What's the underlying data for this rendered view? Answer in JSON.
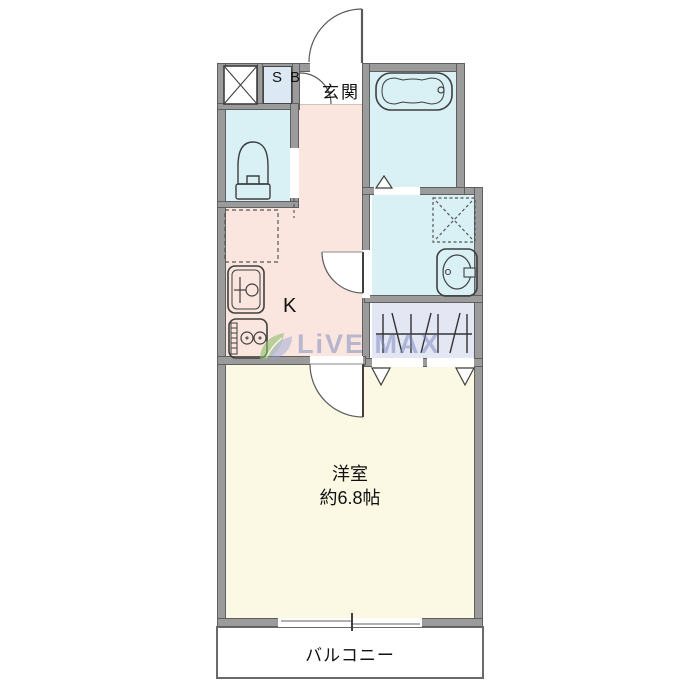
{
  "floorplan": {
    "type": "real-estate-floorplan-1K",
    "rooms": {
      "entrance": {
        "label": "玄関"
      },
      "shoe_box": {
        "label": "SB"
      },
      "kitchen": {
        "label": "K"
      },
      "western_room": {
        "label": "洋室",
        "size": "約6.8帖"
      },
      "balcony": {
        "label": "バルコニー"
      }
    },
    "watermark": {
      "text": "LiVE MAX"
    },
    "colors": {
      "wall_fill": "#9b9b9b",
      "wall_edge": "#5f5f5f",
      "outline": "#3f3f3f",
      "kitchen": "#fae6de",
      "wet_area": "#d9f0f4",
      "closet": "#e3e6f3",
      "western_room": "#fbf8e4",
      "shoe_box_bg": "#dce8f4",
      "entrance_bg": "#ffffff",
      "balcony_bg": "#ffffff",
      "watermark_text": "#8c96c8",
      "watermark_leaf_green": "#8fbf6f",
      "watermark_leaf_blue": "#8fa0d8"
    },
    "fixtures": [
      "pipe-space-x-box",
      "shoe-box",
      "bathtub",
      "toilet",
      "refrigerator-space-dashed",
      "kitchen-sink",
      "gas-stove",
      "washing-machine-space-dashed",
      "washbasin",
      "hanger-pipe",
      "sliding-window",
      "entrance-door-swing",
      "entrance-inner-door-swing",
      "washroom-door-swing",
      "room-door-swing",
      "bathroom-folding-door-triangle",
      "closet-folding-door-triangles",
      "toilet-door-dashed"
    ]
  }
}
